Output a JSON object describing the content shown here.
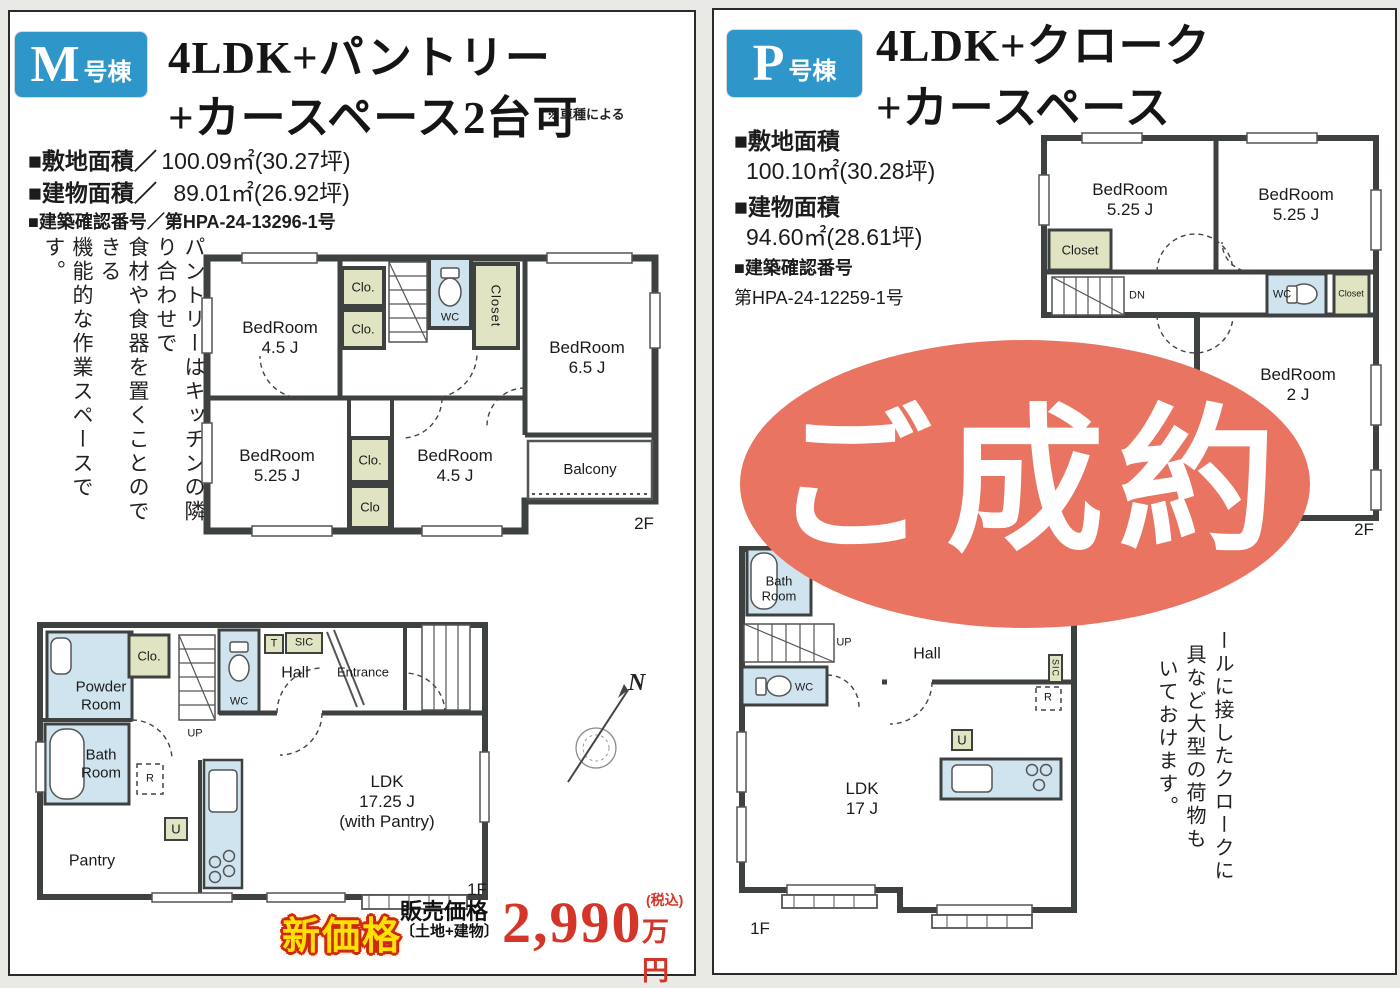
{
  "colors": {
    "accent": "#2e96c8",
    "wall": "#3d4241",
    "water": "#cfe4ee",
    "closet": "#e0e4c2",
    "stamp": "#e87461",
    "price_red": "#d53528",
    "highlight_yellow": "#ffe105",
    "outline_red": "#cf2710",
    "page_bg": "#e9e9e6"
  },
  "left": {
    "badge": {
      "letter": "M",
      "suffix": "号棟"
    },
    "title1": "4LDK+パントリー",
    "title2": "+カースペース2台可",
    "note": "※車種による",
    "spec_site_label": "■敷地面積／",
    "spec_site_value": "100.09㎡(30.27坪)",
    "spec_bldg_label": "■建物面積／",
    "spec_bldg_value": "89.01㎡(26.92坪)",
    "spec_permit": "■建築確認番号／第HPA-24-13296-1号",
    "vcols": [
      "パントリーはキッチンの隣り合わせで",
      "食材や食器を置くことのできる",
      "機能的な作業スペースです。"
    ],
    "compass": "N",
    "f2": {
      "bed1": "BedRoom\n4.5 J",
      "clo1": "Clo.",
      "clo2": "Clo.",
      "wc": "WC",
      "closet": "Closet",
      "bed2": "BedRoom\n6.5 J",
      "bed3": "BedRoom\n5.25 J",
      "clo3": "Clo.",
      "clo4": "Clo",
      "bed4": "BedRoom\n4.5 J",
      "balcony": "Balcony",
      "tag": "2F"
    },
    "f1": {
      "powder": "Powder\nRoom",
      "clo": "Clo.",
      "up": "UP",
      "wc": "WC",
      "t": "T",
      "sic": "SIC",
      "hall": "Hall",
      "entrance": "Entrance",
      "bath": "Bath\nRoom",
      "r": "R",
      "u": "U",
      "pantry": "Pantry",
      "ldk": "LDK\n17.25 J\n(with Pantry)",
      "tag": "1F"
    },
    "price": {
      "badge": "新価格",
      "cap1": "販売価格",
      "cap2": "〔土地+建物〕",
      "amount": "2,990",
      "tax": "(税込)",
      "unit": "万円"
    }
  },
  "right": {
    "badge": {
      "letter": "P",
      "suffix": "号棟"
    },
    "title1": "4LDK+クローク",
    "title2": "+カースペース",
    "spec_site_label": "■敷地面積",
    "spec_site_value": "100.10㎡(30.28坪)",
    "spec_bldg_label": "■建物面積",
    "spec_bldg_value": "94.60㎡(28.61坪)",
    "spec_permit_label": "■建築確認番号",
    "spec_permit_value": "第HPA-24-12259-1号",
    "stamp": "ご成約",
    "f2": {
      "bed1": "BedRoom\n5.25 J",
      "bed2": "BedRoom\n5.25 J",
      "closet1": "Closet",
      "dn": "DN",
      "wc": "WC",
      "closet2": "Closet",
      "bed3": "BedRoom\n2 J",
      "tag": "2F"
    },
    "f1": {
      "bath": "Bath\nRoom",
      "up": "UP",
      "wc": "WC",
      "hall": "Hall",
      "sic": "SIC",
      "r": "R",
      "u": "U",
      "ldk": "LDK\n17 J",
      "tag": "1F"
    },
    "vcols": [
      "ールに接したクロークに",
      "具など大型の荷物も",
      "いておけます。"
    ]
  }
}
